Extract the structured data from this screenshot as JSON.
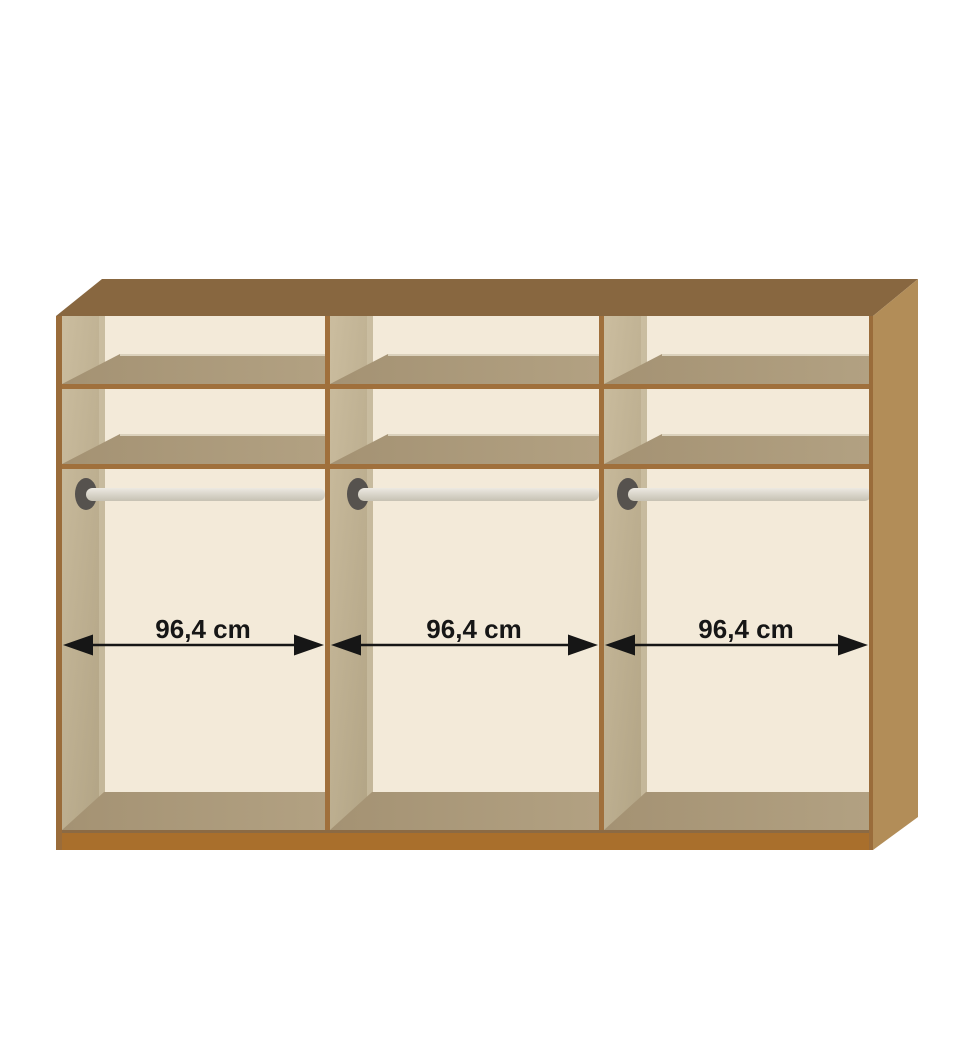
{
  "diagram": {
    "subject": "wardrobe-interior-three-compartments",
    "compartments": [
      {
        "position": "left",
        "width_label": "96,4 cm",
        "shelves_visible": 2,
        "hanging_rails_visible": 1
      },
      {
        "position": "middle",
        "width_label": "96,4 cm",
        "shelves_visible": 2,
        "hanging_rails_visible": 1
      },
      {
        "position": "right",
        "width_label": "96,4 cm",
        "shelves_visible": 2,
        "hanging_rails_visible": 1
      }
    ]
  },
  "colors": {
    "background": "#FFFFFF",
    "top_panel": "#886740",
    "side_panel": "#B28D58",
    "frame_line": "#A0703C",
    "plinth": "#A96F2C",
    "plinth_seam": "#8B6A44",
    "pillar_tan": "#C1B496",
    "shelf_tan": "#AA9879",
    "back_cream": "#F3EAD9",
    "rail_gray": "#DBD7CC",
    "rail_mount_gray": "#56524E",
    "dimension_ink": "#161616"
  }
}
